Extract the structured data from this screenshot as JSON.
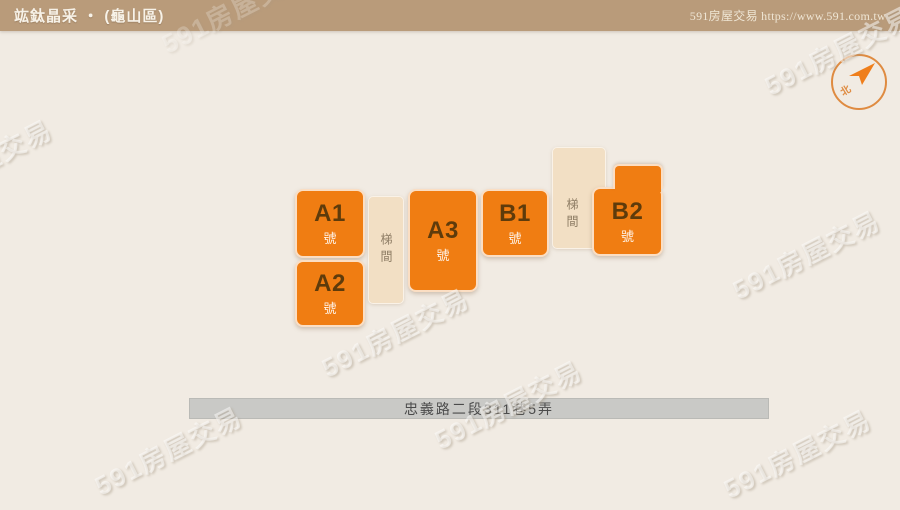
{
  "header": {
    "title": "竑鈦晶采 ‧ (龜山區)",
    "site_label": "591房屋交易 https://www.591.com.tw"
  },
  "compass": {
    "north_label": "北"
  },
  "plan": {
    "units": [
      {
        "name": "A1",
        "suffix": "號"
      },
      {
        "name": "A2",
        "suffix": "號"
      },
      {
        "name": "A3",
        "suffix": "號"
      },
      {
        "name": "B1",
        "suffix": "號"
      },
      {
        "name": "B2",
        "suffix": "號"
      }
    ],
    "stairwells": [
      {
        "label": "梯間"
      },
      {
        "label": "梯間"
      }
    ],
    "road_label": "忠義路二段311巷5弄"
  },
  "watermark": {
    "text": "591房屋交易",
    "positions": [
      {
        "x": 168,
        "y": 450
      },
      {
        "x": 395,
        "y": 332
      },
      {
        "x": 508,
        "y": 404
      },
      {
        "x": 806,
        "y": 254
      },
      {
        "x": 797,
        "y": 453
      },
      {
        "x": 838,
        "y": 50
      },
      {
        "x": -22,
        "y": 163
      },
      {
        "x": 235,
        "y": 8,
        "op": 0.45
      }
    ]
  },
  "colors": {
    "header_bg": "#B99B7A",
    "canvas_bg": "#F1EBE3",
    "unit_orange": "#F07D12",
    "stair_beige": "#F2DFC4",
    "road_gray": "#C9C9C6",
    "compass_orange": "#DF8B41"
  }
}
